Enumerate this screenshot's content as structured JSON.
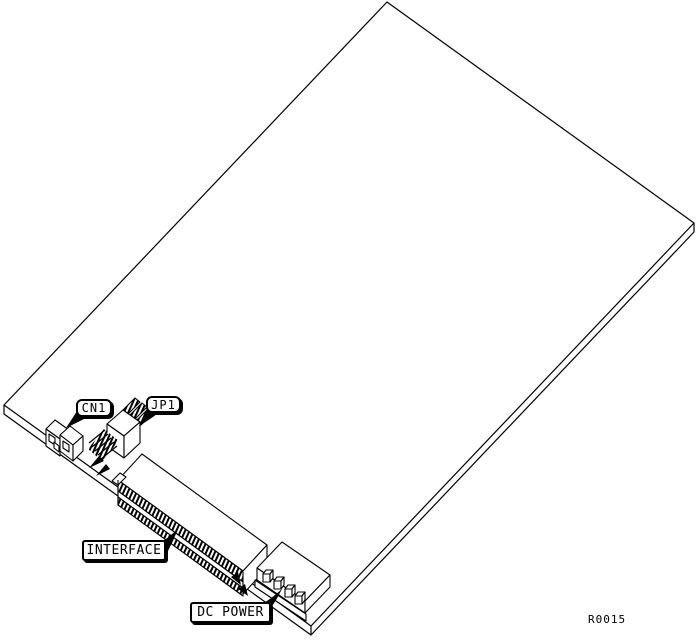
{
  "diagram": {
    "callouts": {
      "cn1": "CN1",
      "jp1": "JP1",
      "interface": "INTERFACE",
      "dc_power": "DC POWER"
    },
    "reference_code": "R0015",
    "colors": {
      "line": "#000000",
      "background": "#ffffff"
    }
  }
}
